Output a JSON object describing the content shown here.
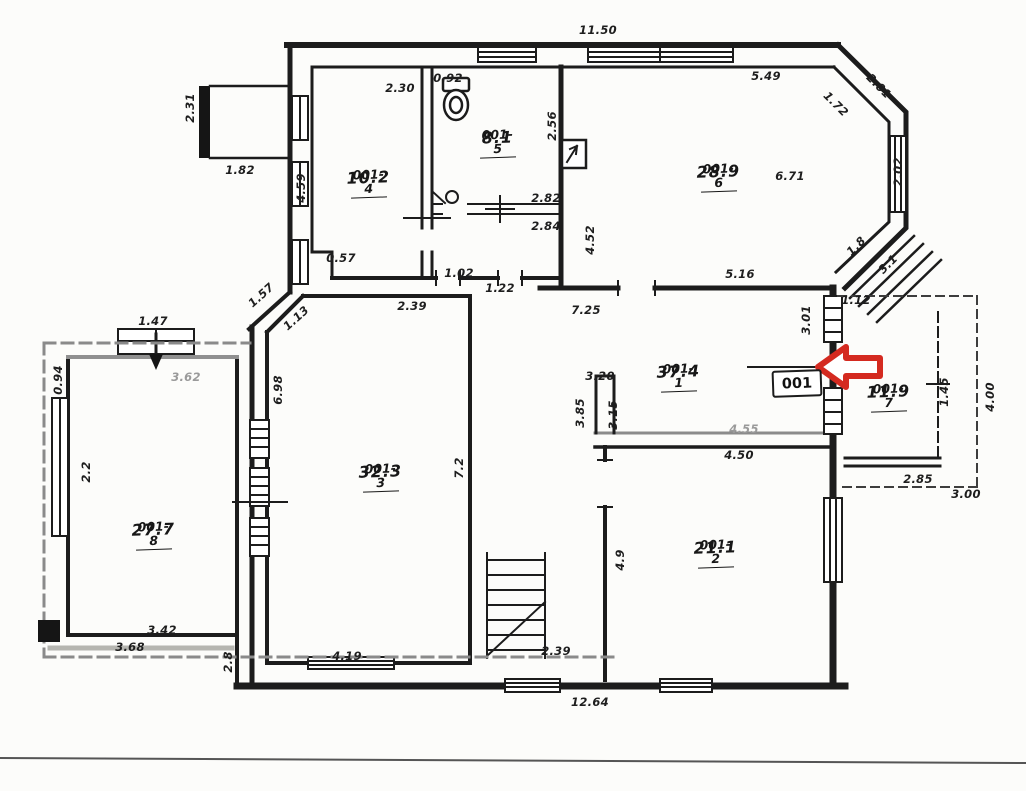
{
  "plan": {
    "type": "scanned-floor-plan",
    "background": "#fcfcfa",
    "wall_color": "#1c1c1c",
    "gray_color": "#8a8a8a",
    "accent_red": "#d42a20"
  },
  "tag": {
    "text": "001"
  },
  "rooms": [
    {
      "id": "001-4",
      "area": "10.2",
      "x": 368,
      "y": 168
    },
    {
      "id": "001-5",
      "area": "8.1",
      "x": 497,
      "y": 128
    },
    {
      "id": "001-6",
      "area": "28.9",
      "x": 718,
      "y": 162
    },
    {
      "id": "001-1",
      "area": "37.4",
      "x": 678,
      "y": 362
    },
    {
      "id": "001-7",
      "area": "11.9",
      "x": 888,
      "y": 382
    },
    {
      "id": "001-3",
      "area": "32.3",
      "x": 380,
      "y": 462
    },
    {
      "id": "001-2",
      "area": "21.1",
      "x": 715,
      "y": 538
    },
    {
      "id": "001-8",
      "area": "27.7",
      "x": 153,
      "y": 520
    }
  ],
  "dimensions": [
    {
      "text": "11.50",
      "x": 598,
      "y": 30,
      "rot": 0
    },
    {
      "text": "2.31",
      "x": 190,
      "y": 108,
      "rot": -90
    },
    {
      "text": "1.82",
      "x": 240,
      "y": 170,
      "rot": 0
    },
    {
      "text": "4.59",
      "x": 301,
      "y": 188,
      "rot": -90
    },
    {
      "text": "2.30",
      "x": 400,
      "y": 88,
      "rot": 0
    },
    {
      "text": "0.92",
      "x": 448,
      "y": 78,
      "rot": 0
    },
    {
      "text": "2.56",
      "x": 552,
      "y": 126,
      "rot": -90
    },
    {
      "text": "2.82",
      "x": 546,
      "y": 198,
      "rot": 0
    },
    {
      "text": "2.84",
      "x": 546,
      "y": 226,
      "rot": 0
    },
    {
      "text": "4.52",
      "x": 590,
      "y": 240,
      "rot": -90
    },
    {
      "text": "5.49",
      "x": 766,
      "y": 76,
      "rot": 0
    },
    {
      "text": "2.01",
      "x": 879,
      "y": 86,
      "rot": 45
    },
    {
      "text": "1.72",
      "x": 836,
      "y": 104,
      "rot": 45
    },
    {
      "text": "6.71",
      "x": 790,
      "y": 176,
      "rot": 0
    },
    {
      "text": "2.02",
      "x": 898,
      "y": 172,
      "rot": -90
    },
    {
      "text": "1.8",
      "x": 856,
      "y": 246,
      "rot": -45
    },
    {
      "text": "3.1",
      "x": 888,
      "y": 264,
      "rot": -45
    },
    {
      "text": "5.16",
      "x": 740,
      "y": 274,
      "rot": 0
    },
    {
      "text": "7.25",
      "x": 586,
      "y": 310,
      "rot": 0
    },
    {
      "text": "3.01",
      "x": 806,
      "y": 320,
      "rot": -90
    },
    {
      "text": "1.12",
      "x": 856,
      "y": 300,
      "rot": 0
    },
    {
      "text": "0.57",
      "x": 341,
      "y": 258,
      "rot": 0
    },
    {
      "text": "1.02",
      "x": 459,
      "y": 273,
      "rot": 0
    },
    {
      "text": "1.22",
      "x": 500,
      "y": 288,
      "rot": 0
    },
    {
      "text": "1.57",
      "x": 261,
      "y": 295,
      "rot": -42
    },
    {
      "text": "1.13",
      "x": 296,
      "y": 318,
      "rot": -42
    },
    {
      "text": "2.39",
      "x": 412,
      "y": 306,
      "rot": 0
    },
    {
      "text": "6.98",
      "x": 278,
      "y": 390,
      "rot": -90
    },
    {
      "text": "7.2",
      "x": 459,
      "y": 468,
      "rot": -90
    },
    {
      "text": "1.47",
      "x": 153,
      "y": 321,
      "rot": 0
    },
    {
      "text": "3.62",
      "x": 186,
      "y": 377,
      "rot": 0,
      "gray": true
    },
    {
      "text": "0.94",
      "x": 58,
      "y": 380,
      "rot": -90
    },
    {
      "text": "2.2",
      "x": 86,
      "y": 472,
      "rot": -90
    },
    {
      "text": "3.42",
      "x": 162,
      "y": 630,
      "rot": 0
    },
    {
      "text": "3.68",
      "x": 130,
      "y": 647,
      "rot": 0
    },
    {
      "text": "2.8",
      "x": 228,
      "y": 662,
      "rot": -90
    },
    {
      "text": "4.19",
      "x": 347,
      "y": 656,
      "rot": 0
    },
    {
      "text": "2.39",
      "x": 556,
      "y": 651,
      "rot": 0
    },
    {
      "text": "12.64",
      "x": 590,
      "y": 702,
      "rot": 0
    },
    {
      "text": "3.20",
      "x": 600,
      "y": 376,
      "rot": 0
    },
    {
      "text": "3.85",
      "x": 580,
      "y": 413,
      "rot": -90
    },
    {
      "text": "3.15",
      "x": 613,
      "y": 415,
      "rot": -90
    },
    {
      "text": "4.55",
      "x": 744,
      "y": 429,
      "rot": 0,
      "gray": true
    },
    {
      "text": "4.50",
      "x": 739,
      "y": 455,
      "rot": 0
    },
    {
      "text": "4.9",
      "x": 620,
      "y": 560,
      "rot": -90
    },
    {
      "text": "2.85",
      "x": 918,
      "y": 479,
      "rot": 0
    },
    {
      "text": "3.00",
      "x": 966,
      "y": 494,
      "rot": 0
    },
    {
      "text": "4.00",
      "x": 990,
      "y": 397,
      "rot": -90
    },
    {
      "text": "1.45",
      "x": 944,
      "y": 392,
      "rot": -90
    }
  ]
}
